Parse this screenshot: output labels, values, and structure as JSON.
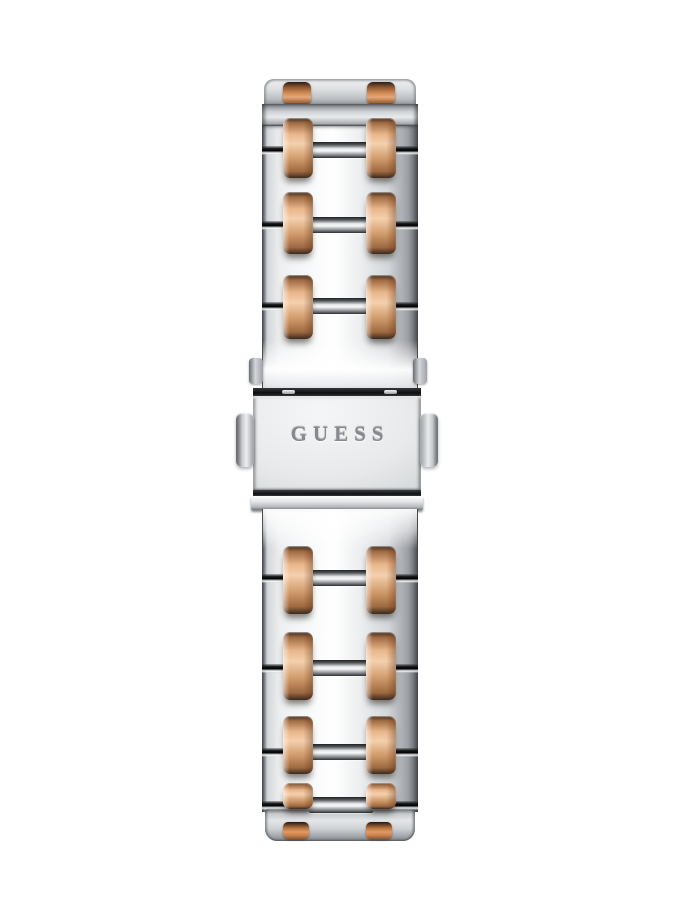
{
  "photo": {
    "description": "Back view of a GUESS two-tone stainless steel watch bracelet with fold-over push-button clasp",
    "background_color": "#ffffff"
  },
  "clasp": {
    "brand_text": "GUESS"
  },
  "colors": {
    "background": "#ffffff",
    "silver_highlight": "#f8f9fa",
    "silver_light": "#eceeef",
    "silver_mid": "#d3d6d9",
    "silver_shadow": "#9da0a5",
    "silver_deep": "#5d6065",
    "seam_dark": "#17191b",
    "rose_gold_highlight": "#f4d0ae",
    "rose_gold_light": "#e8b68a",
    "rose_gold_mid": "#d09a6a",
    "rose_gold_deep": "#a06a42",
    "rose_gold_dark": "#3a2a1e",
    "engraving_gray": "#86898e"
  },
  "bracelet": {
    "band": {
      "left": 262,
      "width": 156
    },
    "gold_columns": {
      "left_x": 283,
      "right_x": 366,
      "bar_width": 30
    },
    "upper": {
      "seams": [
        150,
        225,
        306
      ],
      "bars": [
        {
          "y": 118,
          "h": 60
        },
        {
          "y": 192,
          "h": 62
        },
        {
          "y": 275,
          "h": 64
        }
      ]
    },
    "lower": {
      "seams": [
        578,
        668,
        752,
        805
      ],
      "bars": [
        {
          "y": 546,
          "h": 68
        },
        {
          "y": 632,
          "h": 68
        },
        {
          "y": 716,
          "h": 58
        },
        {
          "y": 783,
          "h": 26
        }
      ]
    }
  }
}
